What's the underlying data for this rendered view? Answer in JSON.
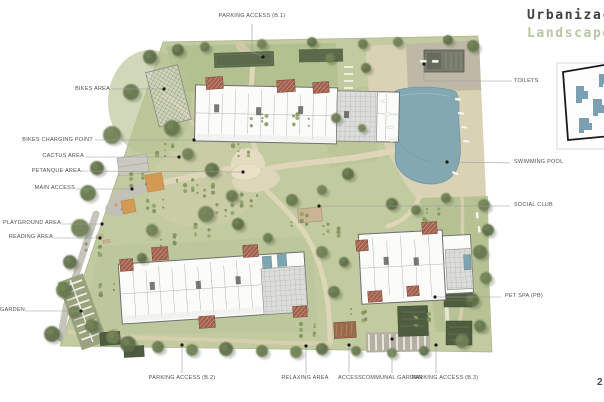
{
  "title": {
    "line1": "Urbanizac",
    "line2": "Landscape"
  },
  "page_number": "2",
  "plan_labels": {
    "parking_b1": "PARKING ACCESS (B.1)",
    "bikes_area": "BIKES AREA",
    "bikes_charging_point": "BIKES CHARGING POINT",
    "cactus_area": "CACTUS AREA",
    "petanque_area": "PETANQUE AREA",
    "main_access": "MAIN ACCESS",
    "playground_area": "PLAYGROUND AREA",
    "reading_area": "READING AREA",
    "garden": "GARDEN",
    "toilets": "TOILETS",
    "swimming_pool": "SWIMMING POOL",
    "social_club": "SOCIAL CLUB",
    "pet_spa": "PET SPA (PB)",
    "parking_b2": "PARKING ACCESS (B.2)",
    "relaxing_area": "RELAXING AREA",
    "access": "ACCESS",
    "communal_garden": "COMMUNAL GARDEN",
    "parking_b3": "PARKING ACCESS (B.3)"
  },
  "colors": {
    "title_primary": "#3f3f3f",
    "title_accent": "#b8c7a3",
    "label_text": "#4f4f4f",
    "site_green": "#c2caa0",
    "lawn_green": "#b2bf8e",
    "pool_blue": "#84a8b2",
    "deck_beige": "#d9d2b4",
    "path_tan": "#ddd6b8",
    "tree_green": "#5e6e48",
    "building_white": "#fbfbf9",
    "pergola_red": "#a2604e",
    "canopy_orange": "#d49a54",
    "garden_plot_green": "#4e5c40",
    "inset_building_blue": "#7ba0b4"
  }
}
